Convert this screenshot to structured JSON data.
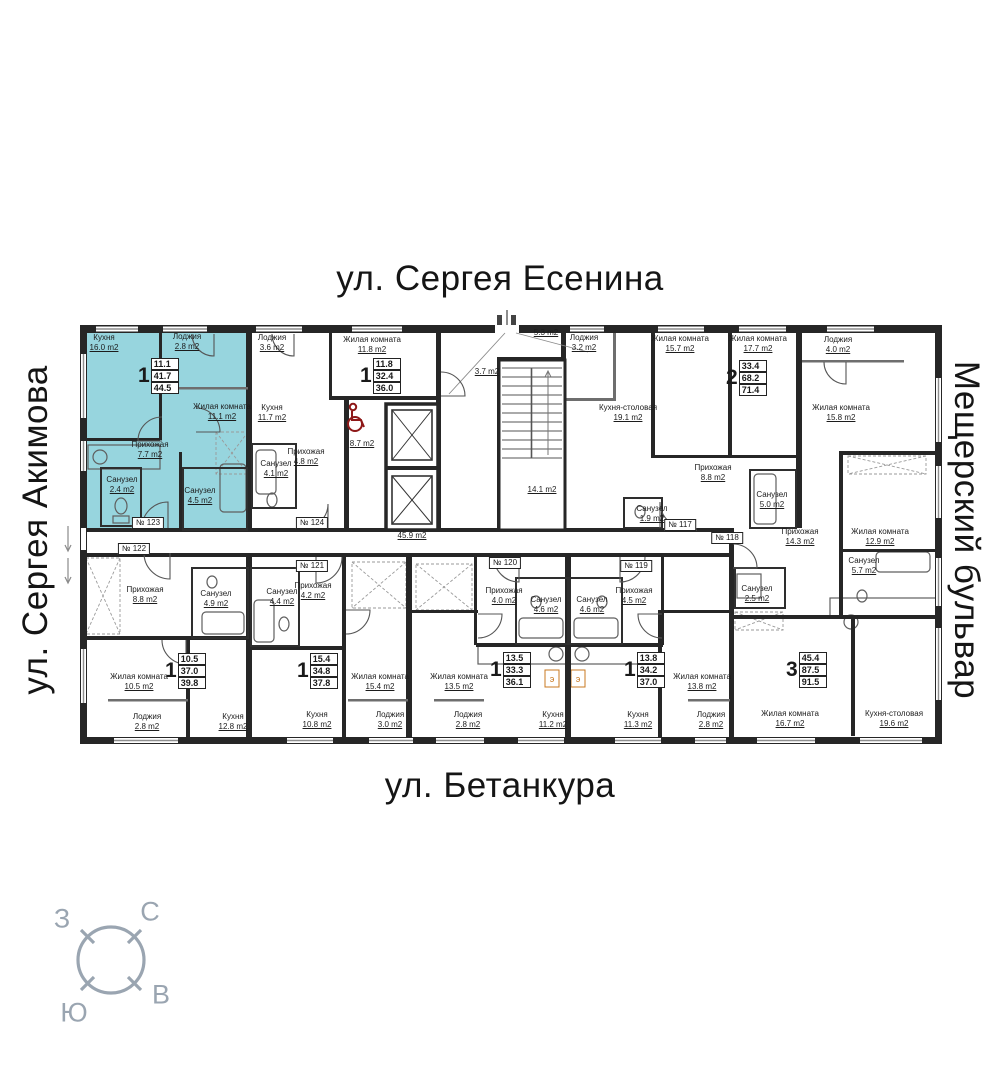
{
  "streets": {
    "top": "ул. Сергея Есенина",
    "left": "ул. Сергея Акимова",
    "right": "Мещерский бульвар",
    "bottom": "ул. Бетанкура"
  },
  "compass": {
    "west": "З",
    "north": "С",
    "east": "В",
    "south": "Ю"
  },
  "colors": {
    "highlight": "#97d5de",
    "wall": "#262626",
    "accent_red": "#8e1818",
    "compass": "#9aa5b1",
    "stove": "#c87820"
  },
  "labels": {
    "stove": "э"
  },
  "room_labels": [
    {
      "name": "Кухня",
      "area": "16.0 m2",
      "x": 104,
      "y": 333
    },
    {
      "name": "Лоджия",
      "area": "2.8 m2",
      "x": 187,
      "y": 332
    },
    {
      "name": "Жилая комната",
      "area": "11.1 m2",
      "x": 222,
      "y": 402
    },
    {
      "name": "Прихожая",
      "area": "7.7 m2",
      "x": 150,
      "y": 440
    },
    {
      "name": "Санузел",
      "area": "2.4 m2",
      "x": 122,
      "y": 475
    },
    {
      "name": "Санузел",
      "area": "4.5 m2",
      "x": 200,
      "y": 486
    },
    {
      "name": "Лоджия",
      "area": "3.6 m2",
      "x": 272,
      "y": 333
    },
    {
      "name": "Жилая комната",
      "area": "11.8 m2",
      "x": 372,
      "y": 335
    },
    {
      "name": "Кухня",
      "area": "11.7 m2",
      "x": 272,
      "y": 403
    },
    {
      "name": "Санузел",
      "area": "4.1 m2",
      "x": 276,
      "y": 459
    },
    {
      "name": "Прихожая",
      "area": "4.8 m2",
      "x": 306,
      "y": 447
    },
    {
      "name": "",
      "area": "8.7 m2",
      "x": 362,
      "y": 439
    },
    {
      "name": "",
      "area": "45.9 m2",
      "x": 412,
      "y": 531
    },
    {
      "name": "",
      "area": "5.3 m2",
      "x": 546,
      "y": 328
    },
    {
      "name": "",
      "area": "3.7 m2",
      "x": 487,
      "y": 367
    },
    {
      "name": "",
      "area": "14.1 m2",
      "x": 542,
      "y": 485
    },
    {
      "name": "Лоджия",
      "area": "3.2 m2",
      "x": 584,
      "y": 333
    },
    {
      "name": "Жилая комната",
      "area": "15.7 m2",
      "x": 680,
      "y": 334
    },
    {
      "name": "Жилая комната",
      "area": "17.7 m2",
      "x": 758,
      "y": 334
    },
    {
      "name": "Кухня-столовая",
      "area": "19.1 m2",
      "x": 628,
      "y": 403
    },
    {
      "name": "Прихожая",
      "area": "8.8 m2",
      "x": 713,
      "y": 463
    },
    {
      "name": "Санузел",
      "area": "1.9 m2",
      "x": 652,
      "y": 504
    },
    {
      "name": "Санузел",
      "area": "5.0 m2",
      "x": 772,
      "y": 490
    },
    {
      "name": "Лоджия",
      "area": "4.0 m2",
      "x": 838,
      "y": 335
    },
    {
      "name": "Жилая комната",
      "area": "15.8 m2",
      "x": 841,
      "y": 403
    },
    {
      "name": "Жилая комната",
      "area": "12.9 m2",
      "x": 880,
      "y": 527
    },
    {
      "name": "Прихожая",
      "area": "14.3 m2",
      "x": 800,
      "y": 527
    },
    {
      "name": "Санузел",
      "area": "5.7 m2",
      "x": 864,
      "y": 556
    },
    {
      "name": "Санузел",
      "area": "2.5 m2",
      "x": 757,
      "y": 584
    },
    {
      "name": "Жилая комната",
      "area": "16.7 m2",
      "x": 790,
      "y": 709
    },
    {
      "name": "Кухня-столовая",
      "area": "19.6 m2",
      "x": 894,
      "y": 709
    },
    {
      "name": "Прихожая",
      "area": "4.5 m2",
      "x": 634,
      "y": 586
    },
    {
      "name": "Санузел",
      "area": "4.6 m2",
      "x": 592,
      "y": 595
    },
    {
      "name": "Кухня",
      "area": "11.3 m2",
      "x": 638,
      "y": 710
    },
    {
      "name": "Жилая комната",
      "area": "13.8 m2",
      "x": 702,
      "y": 672
    },
    {
      "name": "Лоджия",
      "area": "2.8 m2",
      "x": 711,
      "y": 710
    },
    {
      "name": "Прихожая",
      "area": "4.0 m2",
      "x": 504,
      "y": 586
    },
    {
      "name": "Санузел",
      "area": "4.6 m2",
      "x": 546,
      "y": 595
    },
    {
      "name": "Жилая комната",
      "area": "13.5 m2",
      "x": 459,
      "y": 672
    },
    {
      "name": "Лоджия",
      "area": "2.8 m2",
      "x": 468,
      "y": 710
    },
    {
      "name": "Кухня",
      "area": "11.2 m2",
      "x": 553,
      "y": 710
    },
    {
      "name": "Прихожая",
      "area": "4.2 m2",
      "x": 313,
      "y": 581
    },
    {
      "name": "Санузел",
      "area": "4.4 m2",
      "x": 282,
      "y": 587
    },
    {
      "name": "Жилая комната",
      "area": "15.4 m2",
      "x": 380,
      "y": 672
    },
    {
      "name": "Лоджия",
      "area": "3.0 m2",
      "x": 390,
      "y": 710
    },
    {
      "name": "Кухня",
      "area": "10.8 m2",
      "x": 317,
      "y": 710
    },
    {
      "name": "Прихожая",
      "area": "8.8 m2",
      "x": 145,
      "y": 585
    },
    {
      "name": "Санузел",
      "area": "4.9 m2",
      "x": 216,
      "y": 589
    },
    {
      "name": "Жилая комната",
      "area": "10.5 m2",
      "x": 139,
      "y": 672
    },
    {
      "name": "Лоджия",
      "area": "2.8 m2",
      "x": 147,
      "y": 712
    },
    {
      "name": "Кухня",
      "area": "12.8 m2",
      "x": 233,
      "y": 712
    }
  ],
  "plates": [
    {
      "text": "№ 123",
      "x": 148,
      "y": 523
    },
    {
      "text": "№ 124",
      "x": 312,
      "y": 523
    },
    {
      "text": "№ 117",
      "x": 680,
      "y": 525
    },
    {
      "text": "№ 118",
      "x": 727,
      "y": 538
    },
    {
      "text": "№ 122",
      "x": 134,
      "y": 549
    },
    {
      "text": "№ 121",
      "x": 312,
      "y": 566
    },
    {
      "text": "№ 120",
      "x": 505,
      "y": 563
    },
    {
      "text": "№ 119",
      "x": 636,
      "y": 566
    }
  ],
  "summaries": [
    {
      "digit": "1",
      "values": [
        "11.1",
        "41.7",
        "44.5"
      ],
      "x": 138,
      "y": 358
    },
    {
      "digit": "1",
      "values": [
        "11.8",
        "32.4",
        "36.0"
      ],
      "x": 360,
      "y": 358
    },
    {
      "digit": "2",
      "values": [
        "33.4",
        "68.2",
        "71.4"
      ],
      "x": 726,
      "y": 360
    },
    {
      "digit": "3",
      "values": [
        "45.4",
        "87.5",
        "91.5"
      ],
      "x": 786,
      "y": 652
    },
    {
      "digit": "1",
      "values": [
        "10.5",
        "37.0",
        "39.8"
      ],
      "x": 165,
      "y": 653
    },
    {
      "digit": "1",
      "values": [
        "15.4",
        "34.8",
        "37.8"
      ],
      "x": 297,
      "y": 653
    },
    {
      "digit": "1",
      "values": [
        "13.5",
        "33.3",
        "36.1"
      ],
      "x": 490,
      "y": 652
    },
    {
      "digit": "1",
      "values": [
        "13.8",
        "34.2",
        "37.0"
      ],
      "x": 624,
      "y": 652
    }
  ]
}
